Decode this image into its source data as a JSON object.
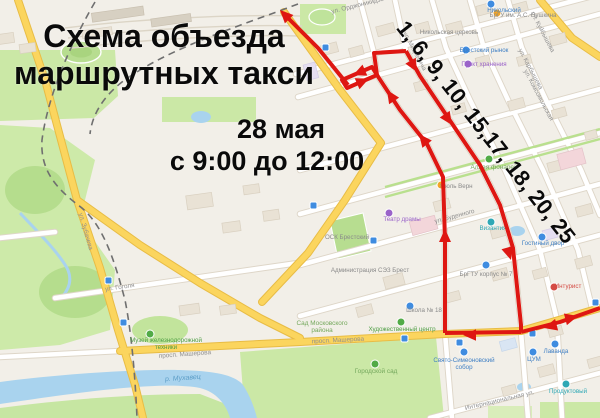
{
  "overlay": {
    "title_line1": "Схема объезда",
    "title_line2": "маршрутных такси",
    "date": "28 мая",
    "time": "с 9:00 до 12:00",
    "routes": "1, 6, 9, 10, 15,17, 18, 20, 25"
  },
  "colors": {
    "route_red": "#de1712",
    "road_yellow": "#fbd55e",
    "water_blue": "#a9d3ee",
    "park_green": "#cbe8a6",
    "text_black": "#0a0a0a"
  },
  "map": {
    "labels": [
      {
        "t": "ул. Зубачева"
      },
      {
        "t": "ул. Гоголя"
      },
      {
        "t": "просп. Машерова"
      },
      {
        "t": "просп. Машерова"
      },
      {
        "t": "ул. Мицкевича"
      },
      {
        "t": "ул. Куйбышева"
      },
      {
        "t": "ул. Карбышева"
      },
      {
        "t": "ул. Буденного"
      },
      {
        "t": "ул. Орджоникидзе"
      },
      {
        "t": "ул. Комсомольская"
      },
      {
        "t": "Интернациональная ул."
      },
      {
        "t": "р. Мухавец"
      },
      {
        "t": "Городской сад"
      },
      {
        "t": "Сад Московского"
      },
      {
        "t": "района"
      },
      {
        "t": "Аллея фонарей"
      },
      {
        "t": "ОСК Брестский"
      },
      {
        "t": "Музей железнодорожной"
      },
      {
        "t": "техники"
      },
      {
        "t": "Театр драмы"
      },
      {
        "t": "Гостиный двор"
      },
      {
        "t": "БрГТУ корпус № 7"
      },
      {
        "t": "БрГУ им. А.С. Пушкина"
      },
      {
        "t": "Никольская церковь"
      },
      {
        "t": "Брестский рынок"
      },
      {
        "t": "Пункт хранения"
      },
      {
        "t": "Администрация СЭЗ Брест"
      },
      {
        "t": "Жюль Верн"
      },
      {
        "t": "Школа № 18"
      },
      {
        "t": "Интурист"
      },
      {
        "t": "Свято-Симеоновский"
      },
      {
        "t": "собор"
      },
      {
        "t": "Византия"
      },
      {
        "t": "ЦУМ"
      },
      {
        "t": "Лаванда"
      },
      {
        "t": "Никольский"
      },
      {
        "t": "Художественный центр"
      },
      {
        "t": "Продуктовый"
      }
    ]
  }
}
